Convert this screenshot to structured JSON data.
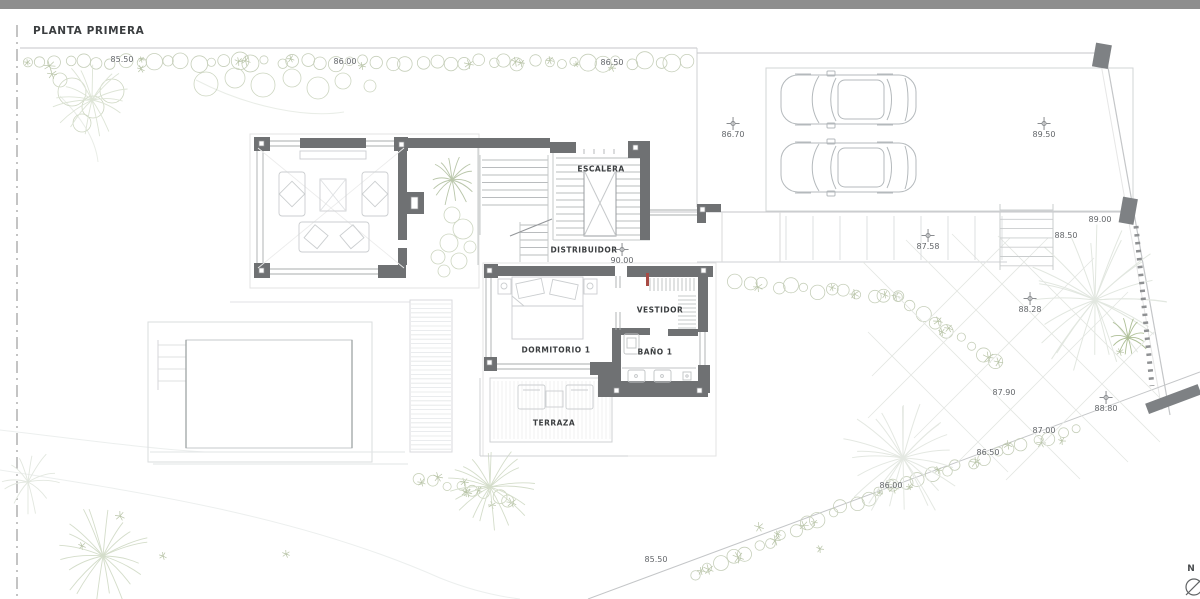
{
  "title": "PLANTA PRIMERA",
  "rooms": {
    "escalera": "ESCALERA",
    "distribuidor": "DISTRIBUIDOR",
    "dormitorio1": "DORMITORIO 1",
    "vestidor": "VESTIDOR",
    "bano1": "BAÑO 1",
    "terraza": "TERRAZA"
  },
  "compass": {
    "north_label": "N"
  },
  "elevations": [
    {
      "value": "85.50",
      "x": 122,
      "y": 60,
      "cross": false
    },
    {
      "value": "86.00",
      "x": 345,
      "y": 62,
      "cross": false
    },
    {
      "value": "86.50",
      "x": 612,
      "y": 63,
      "cross": false
    },
    {
      "value": "86.70",
      "x": 733,
      "y": 128,
      "cross": true
    },
    {
      "value": "89.50",
      "x": 1044,
      "y": 128,
      "cross": true
    },
    {
      "value": "90.00",
      "x": 622,
      "y": 254,
      "cross": true
    },
    {
      "value": "89.00",
      "x": 1100,
      "y": 220,
      "cross": false
    },
    {
      "value": "88.50",
      "x": 1066,
      "y": 236,
      "cross": false
    },
    {
      "value": "87.58",
      "x": 928,
      "y": 240,
      "cross": true
    },
    {
      "value": "88.28",
      "x": 1030,
      "y": 303,
      "cross": true
    },
    {
      "value": "87.90",
      "x": 1004,
      "y": 393,
      "cross": false
    },
    {
      "value": "88.80",
      "x": 1106,
      "y": 402,
      "cross": true
    },
    {
      "value": "87.00",
      "x": 1044,
      "y": 431,
      "cross": false
    },
    {
      "value": "86.50",
      "x": 988,
      "y": 453,
      "cross": false
    },
    {
      "value": "86.00",
      "x": 891,
      "y": 486,
      "cross": false
    },
    {
      "value": "85.50",
      "x": 656,
      "y": 560,
      "cross": false
    }
  ],
  "colors": {
    "wall": "#6f7173",
    "vegetation": "#c6cfba",
    "boundary": "#c4c6c8",
    "accent_red": "#a84a44",
    "top_strip": "#8e8e8e",
    "label_text": "#3b3e40",
    "elevation_text": "#63666a"
  }
}
